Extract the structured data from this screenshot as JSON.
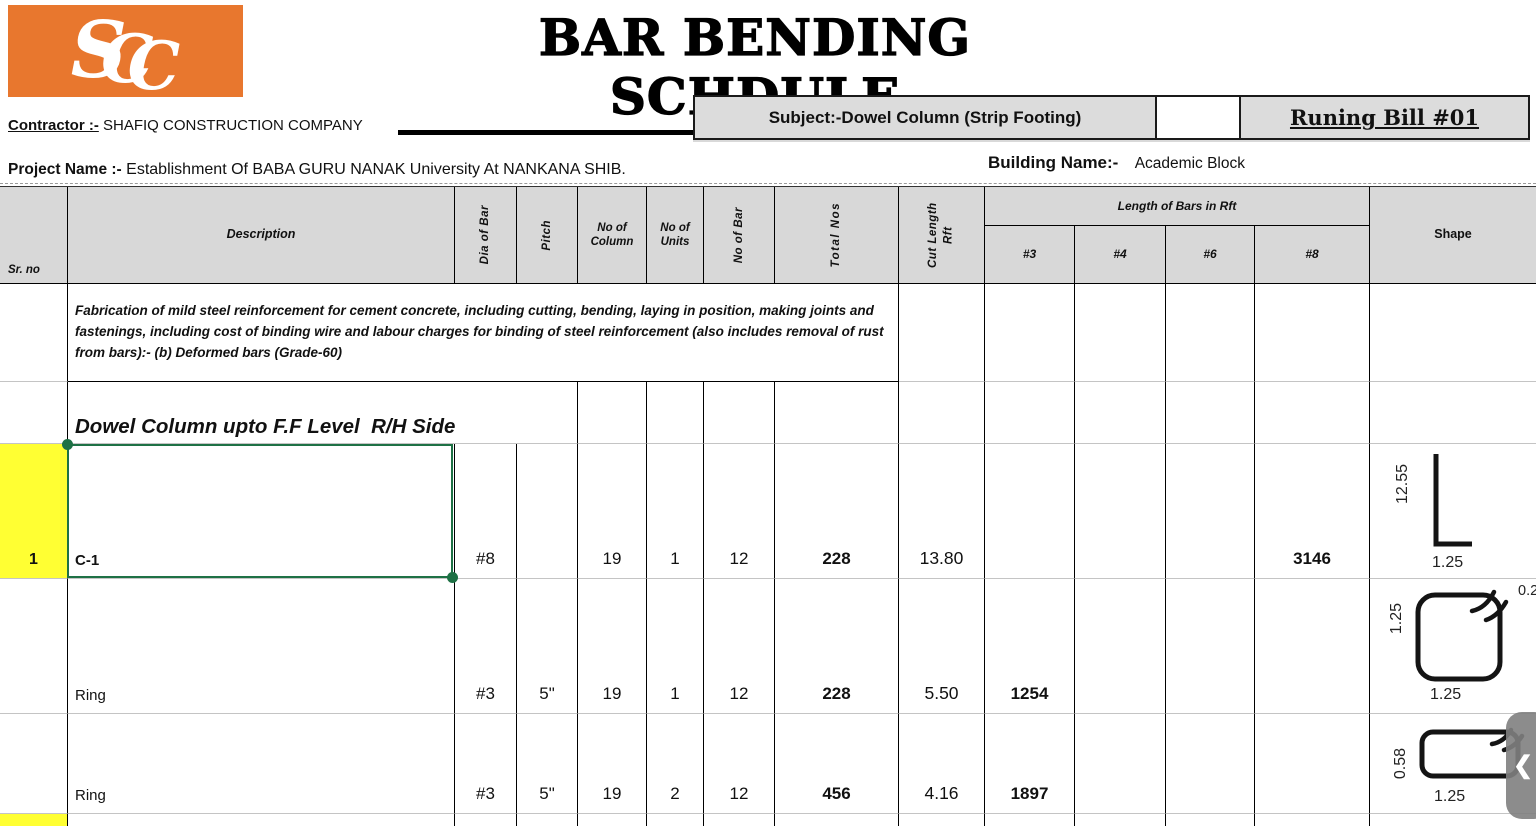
{
  "logo": {
    "letters": [
      "S",
      "C",
      "C"
    ],
    "bg_color": "#E8772E"
  },
  "title": "BAR BENDING SCHDULE",
  "meta": {
    "contractor_label": "Contractor :-",
    "contractor_value": "SHAFIQ CONSTRUCTION COMPANY",
    "project_label": "Project Name :-",
    "project_value": "Establishment Of BABA GURU NANAK University At NANKANA SHIB.",
    "subject": "Subject:-Dowel Column (Strip Footing)",
    "running_bill": "Runing Bill #01",
    "building_label": "Building Name:-",
    "building_value": "Academic Block"
  },
  "table": {
    "headers": {
      "sr": "Sr. no",
      "description": "Description",
      "dia": "Dia of Bar",
      "pitch": "Pitch",
      "no_of_column": "No of Column",
      "no_of_units": "No of Units",
      "no_of_bar": "No of Bar",
      "total_nos": "Total Nos",
      "cut_length": "Cut Length Rft",
      "length_group": "Length of Bars in Rft",
      "sub": [
        "#3",
        "#4",
        "#6",
        "#8"
      ],
      "shape": "Shape"
    },
    "note": "Fabrication of mild steel reinforcement for cement concrete, including cutting, bending, laying in position, making joints and fastenings, including cost of binding wire and labour charges for binding of steel reinforcement (also includes removal of rust from bars):- (b) Deformed bars (Grade-60)",
    "section_heading": "Dowel Column upto F.F Level  R/H Side",
    "rows": [
      {
        "sr": "1",
        "desc": "C-1",
        "dia": "#8",
        "pitch": "",
        "col": "19",
        "units": "1",
        "bars": "12",
        "total": "228",
        "cut": "13.80",
        "l3": "",
        "l4": "",
        "l6": "",
        "l8": "3146",
        "shape": {
          "kind": "L-bar",
          "v": "12.55",
          "h": "1.25"
        }
      },
      {
        "sr": "",
        "desc": "Ring",
        "dia": "#3",
        "pitch": "5\"",
        "col": "19",
        "units": "1",
        "bars": "12",
        "total": "228",
        "cut": "5.50",
        "l3": "1254",
        "l4": "",
        "l6": "",
        "l8": "",
        "shape": {
          "kind": "closed-ring",
          "v": "1.25",
          "h": "1.25",
          "hook": "0.25"
        }
      },
      {
        "sr": "",
        "desc": "Ring",
        "dia": "#3",
        "pitch": "5\"",
        "col": "19",
        "units": "2",
        "bars": "12",
        "total": "456",
        "cut": "4.16",
        "l3": "1897",
        "l4": "",
        "l6": "",
        "l8": "",
        "shape": {
          "kind": "closed-ring",
          "v": "0.58",
          "h": "1.25"
        }
      }
    ]
  },
  "overlay": {
    "chevron": "❮"
  },
  "colors": {
    "logo_orange": "#E8772E",
    "header_gray": "#D8D8D8",
    "subject_gray": "#DCDCDC",
    "highlight_yellow": "#FFFF33",
    "selection_green": "#1E7145",
    "nav_tab_gray": "#808080"
  }
}
